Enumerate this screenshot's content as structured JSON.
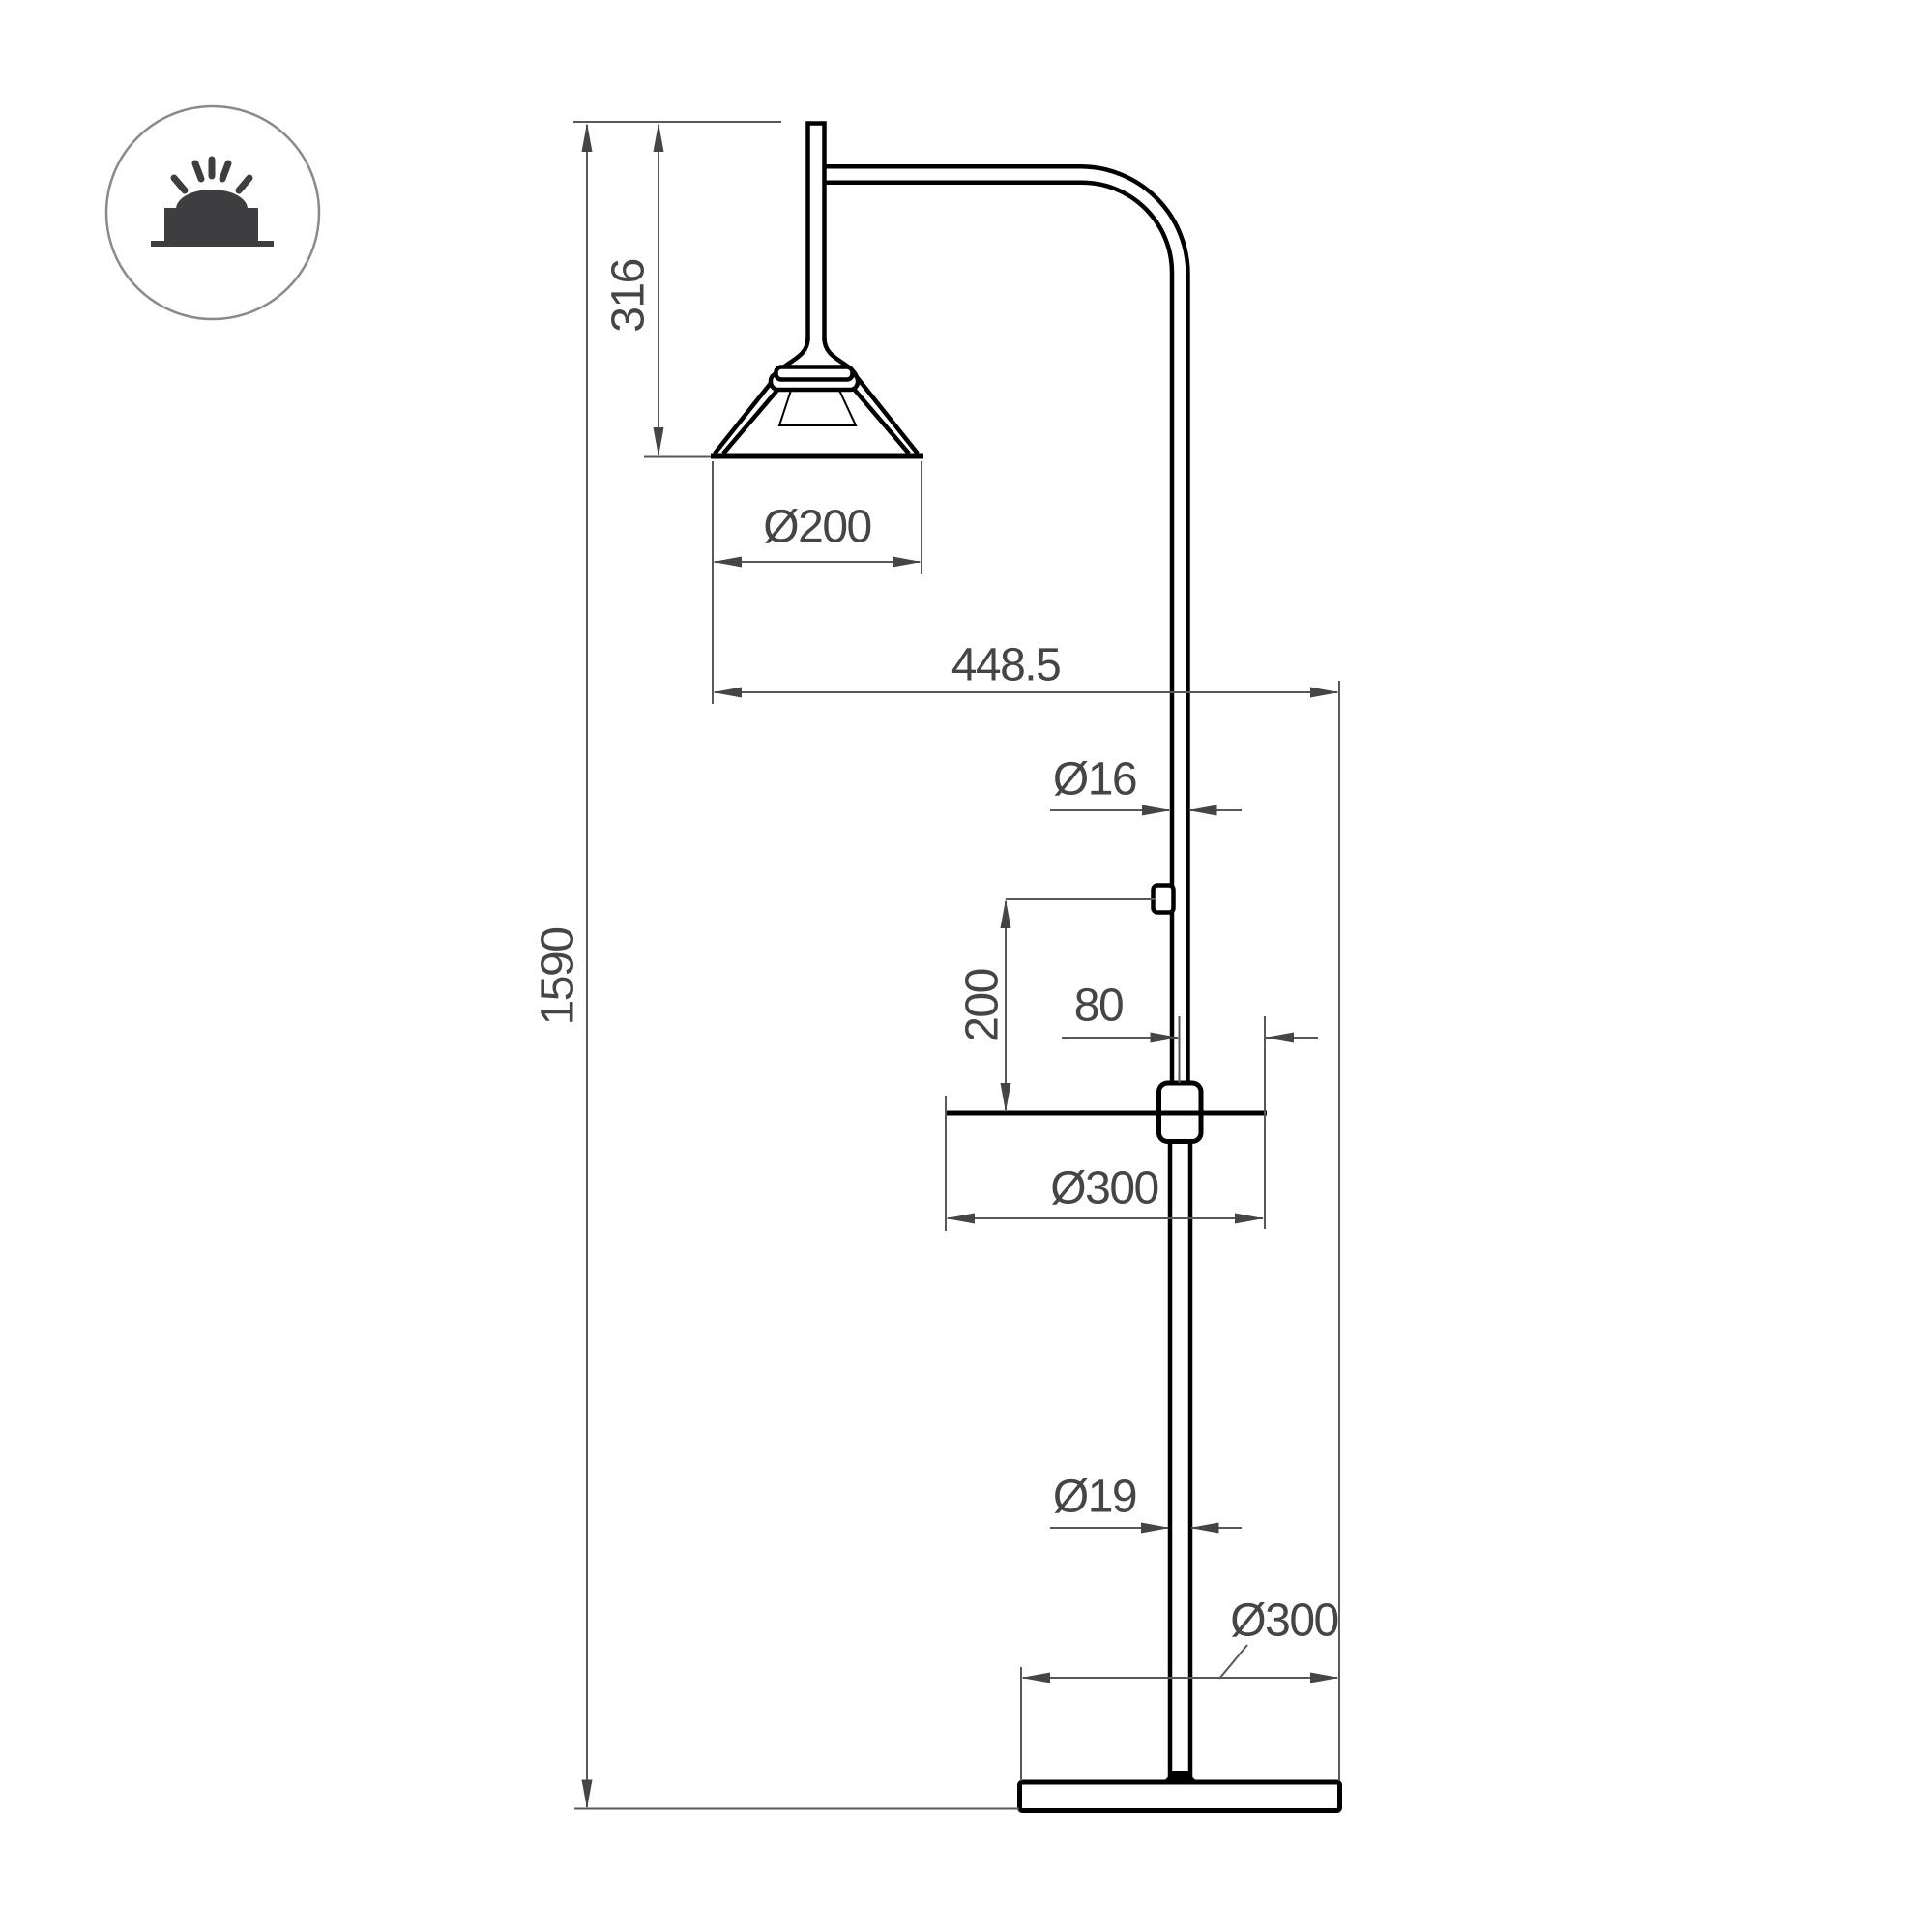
{
  "page": {
    "background": "#ffffff"
  },
  "icon": {
    "name": "surface-mounted-lamp-icon",
    "glyph_color": "#3e3e40",
    "ring_color": "#8a8a8a"
  },
  "drawing": {
    "subject": "floor-lamp-with-table-technical-drawing",
    "object_line_color": "#000000",
    "dimension_color": "#454547"
  },
  "dimensions": {
    "total_height": "1590",
    "head_drop": "316",
    "shade_diameter": "Ø200",
    "arm_reach": "448.5",
    "upper_pole_diameter": "Ø16",
    "switch_above_table": "200",
    "pole_to_table_edge": "80",
    "table_diameter": "Ø300",
    "lower_pole_diameter": "Ø19",
    "base_diameter": "Ø300"
  }
}
